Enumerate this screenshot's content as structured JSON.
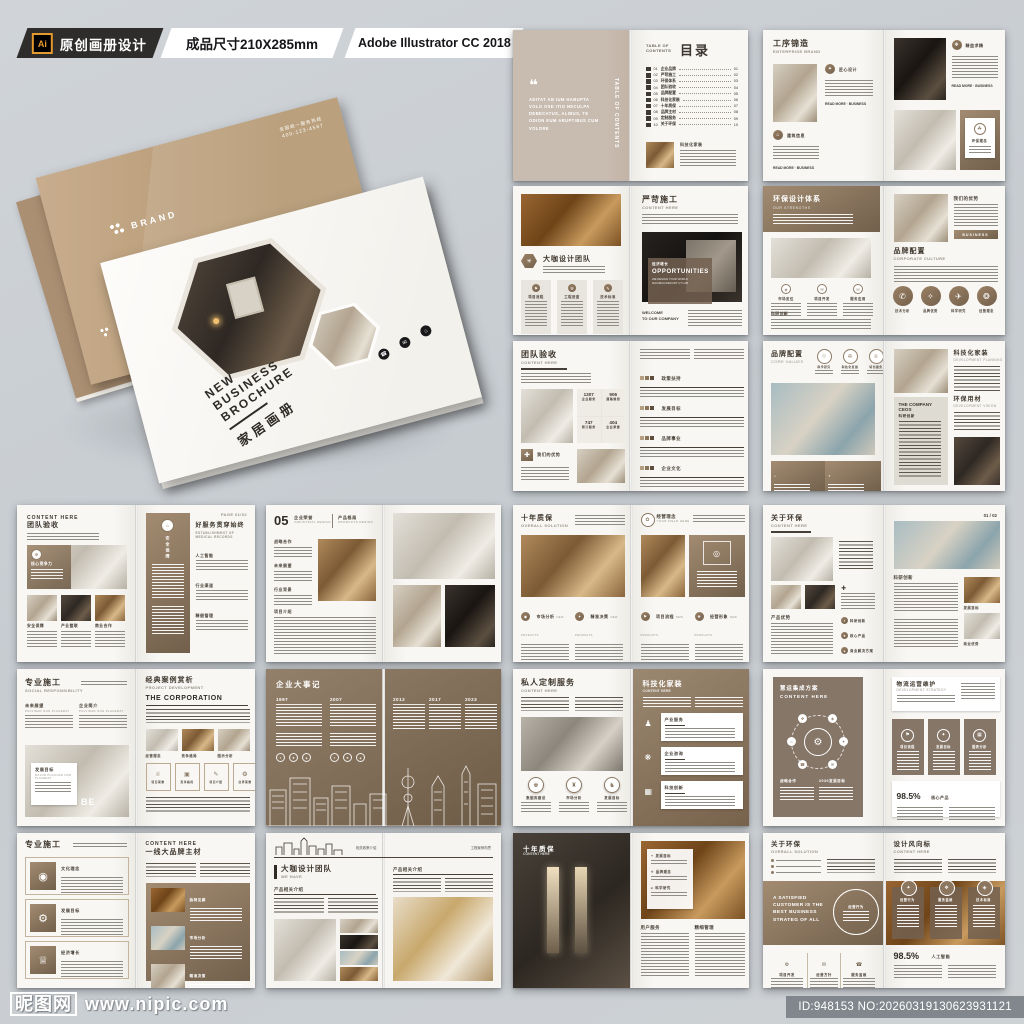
{
  "header": {
    "ai": "Ai",
    "brand": "原创画册设计",
    "size": "成品尺寸210X285mm",
    "software": "Adobe Illustrator CC 2018"
  },
  "watermark": {
    "site": "昵图网",
    "url": "www.nipic.com",
    "id": "ID:948153 NO:20260319130623931121"
  },
  "palette": {
    "accent_brown": "#a08567",
    "badge_dark": "#2e2d2b",
    "ai_orange": "#e59a2f",
    "page": "#f6f5f2"
  },
  "cover": {
    "brand": "BRAND",
    "hotline_label": "全国统一服务热线",
    "hotline": "400-123-4567",
    "en1": "NEW",
    "en2": "BUSINESS",
    "en3": "BROCHURE",
    "cn": "家居画册"
  },
  "s01": {
    "quote": "ADITAT AB IUM HABUPTA VOLO OSE ITIO NECULPA DEBECATUS, ALIBUS, TE ODION EUM ARUPTIBUS CUM VOLORE",
    "side": "TABLE OF CONTENTS",
    "toc_en": "TABLE OF CONTENTS",
    "title": "目录",
    "items": [
      {
        "no": "01",
        "label": "企业品牌"
      },
      {
        "no": "02",
        "label": "严苛施工"
      },
      {
        "no": "03",
        "label": "环保体系"
      },
      {
        "no": "04",
        "label": "团队验收"
      },
      {
        "no": "05",
        "label": "品牌配置"
      },
      {
        "no": "06",
        "label": "科技化家装"
      },
      {
        "no": "07",
        "label": "十年质保"
      },
      {
        "no": "08",
        "label": "品牌主材"
      },
      {
        "no": "09",
        "label": "定制服务"
      },
      {
        "no": "10",
        "label": "关于环保"
      }
    ],
    "foot": "科技化家装"
  },
  "s02": {
    "cn": "工序锦造",
    "en": "ENTERPRISE BRAND",
    "sec1": "匠心设计",
    "sec2": "建筑信息",
    "sec3": "精益求精",
    "sec4": "环保理念",
    "more": "READ MORE",
    "biz": "BUSINESS"
  },
  "s03": {
    "l_cn": "大咖设计团队",
    "cols": [
      "项目流程",
      "工程进度",
      "技术标准"
    ],
    "r_cn": "严苛施工",
    "r_en": "CONTENT HERE",
    "ov_cn": "经济增长",
    "ov_en": "OPPORTUNITIES",
    "ov_sub": "WE DESIGN YOUR WORLD MAXIMACIOEKUNT UT LAB",
    "welcome1": "WELCOME",
    "welcome2": "TO OUR COMPANY"
  },
  "s04": {
    "l_cn": "环保设计体系",
    "l_en": "OUR STRENGTHS",
    "cols": [
      "市场定位",
      "项目开发",
      "服务应用"
    ],
    "l_sec": "科研创新",
    "r_lab": "我们的优势",
    "btn": "BUSINESS",
    "r_cn": "品牌配置",
    "r_en": "CORPORATE CULTURE",
    "circles": [
      "技术分析",
      "品牌优势",
      "科学研究",
      "经营理念"
    ]
  },
  "s05": {
    "cn": "团队验收",
    "en": "CONTENT HERE",
    "stats": [
      {
        "v": "1307",
        "l": "企业服务"
      },
      {
        "v": "906",
        "l": "道路规划"
      },
      {
        "v": "747",
        "l": "预订服务"
      },
      {
        "v": "404",
        "l": "企业荣誉"
      }
    ],
    "adv": "我们的优势",
    "secs": [
      "政策扶持",
      "发展目标",
      "品牌事业",
      "企业文化"
    ]
  },
  "s06": {
    "cn": "品牌配置",
    "en": "CORE VALUES",
    "circles": [
      "科学研究",
      "科技化发展",
      "特色服务"
    ],
    "company": "THE COMPANY CEOS",
    "company_sub": "科研创新",
    "r1": "科技化家装",
    "r1e": "DEVELOPMENT PLANNING",
    "r2": "环保用材",
    "r2e": "DEVELOPMENT VISION"
  },
  "s07": {
    "en": "CONTENT HERE",
    "cn": "团队验收",
    "ov": "核心竞争力",
    "labels": [
      "安全保障",
      "产业整联",
      "商业合作"
    ],
    "panel": "安全保障",
    "r_cn": "好服务贯穿始终",
    "r_en": "ESTABLISHMENT OF MEDICAL RECORDS",
    "secs": [
      "人工智能",
      "行业渠道",
      "精细管理"
    ],
    "page": "PAGE 01/02"
  },
  "s08": {
    "num": "05",
    "h1": "企业荣誉",
    "h1e": "INDUSTRIAL DESIGN",
    "h2": "产品格局",
    "h2e": "PRODUCTS DESIGN",
    "secs": [
      "战略合作",
      "未来展望",
      "行业背景"
    ],
    "sec4": "项目介绍"
  },
  "s09": {
    "cn": "十年质保",
    "en": "OVERALL SOLUTION",
    "r_cn": "经营理念",
    "r_en": "YOUR FIELD HERE",
    "cols": [
      "市场分析",
      "精准决策",
      "项目流程",
      "经营形象"
    ],
    "sub": "NEW PRODUCTS"
  },
  "s10": {
    "cn": "关于环保",
    "en": "CONTENT HERE",
    "adv": "产品优势",
    "bullets": [
      "科研创新",
      "核心产品",
      "商业解决方案"
    ],
    "page": "01 / 02",
    "r_sec": "科研创新",
    "cap1": "发展目标",
    "cap2": "商业优势"
  },
  "s11": {
    "cn": "专业施工",
    "en": "SOCIAL RESPONSIBILITY",
    "sub1": "未来展望",
    "sub2": "企业简介",
    "latin": "PULVINAR NON PLACERAT",
    "card": "发展目标",
    "card_en": "DOLOR PULVINAR NON PLACERAT",
    "be": "BE",
    "r_cn": "经典案例赏析",
    "r_en": "PROJECT DEVELOPMENT",
    "corp": "THE CORPORATION",
    "plabels": [
      "经营理念",
      "竞争格局",
      "图示分析"
    ],
    "boxes": [
      "项目荣誉",
      "竞争格局",
      "项目介绍",
      "业界荣誉"
    ]
  },
  "s12": {
    "title": "企业大事记",
    "years": [
      "1997",
      "2007",
      "2012",
      "2017",
      "2023"
    ]
  },
  "s13": {
    "cn": "私人定制服务",
    "en": "CONTENT HERE",
    "circles": [
      "数据库建设",
      "市场分析",
      "发展目标"
    ],
    "r_cn": "科技化家装",
    "r_en": "CONTENT HERE",
    "cards": [
      "产业服务",
      "企业咨询",
      "科技创新"
    ]
  },
  "s14": {
    "card_cn": "慧运集成方案",
    "card_en": "CONTENT HERE",
    "lab1": "战略合作",
    "lab2": "2030发展目标",
    "r_cn": "物流运营维护",
    "r_en": "DEVELOPMENT STRATEGY",
    "cards": [
      "项目流程",
      "发展目标",
      "图表分析"
    ],
    "pct": "98.5%",
    "pct_lab": "核心产品"
  },
  "s15": {
    "cn": "专业施工",
    "cards": [
      "文化理念",
      "发展目标",
      "经济增长"
    ],
    "r_en": "CONTENT HERE",
    "r_cn": "一线大品牌主材",
    "plabels": [
      "独特见解",
      "市场分析",
      "精准决策"
    ]
  },
  "s16": {
    "cn": "大咖设计团队",
    "en": "WE HAVE",
    "sec": "产品相关介绍",
    "r_sec": "产品相关介绍",
    "head_mid": "相关政策介绍",
    "head_right": "工程案例构思"
  },
  "s17": {
    "cn": "十年质保",
    "en": "CONTENT HERE",
    "list": [
      "发展目标",
      "品牌理念",
      "科学研究"
    ],
    "sec1": "用户服务",
    "sec2": "精细管理"
  },
  "s18": {
    "cn": "关于环保",
    "en": "OVERALL SOLUTION",
    "r_cn": "设计风向标",
    "r_en": "CONTENT HERE",
    "banner": "A SATISFIED CUSTOMER IS THE BEST BUSINESS STRATEG OF ALL",
    "wheel": "经营行为",
    "cards": [
      "经营行为",
      "服务监维",
      "技术标准"
    ],
    "cols": [
      "项目开发",
      "经营方针",
      "服务监维"
    ],
    "pct": "98.5%",
    "pct_lab": "人工智能"
  }
}
